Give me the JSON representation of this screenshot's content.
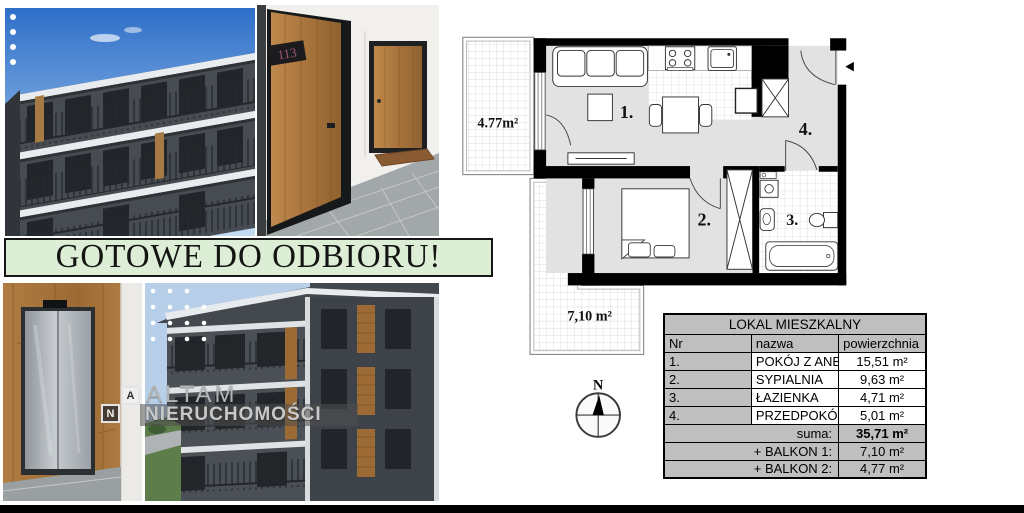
{
  "banner": {
    "text": "GOTOWE DO ODBIORU!"
  },
  "watermark": {
    "logo_a": "A",
    "logo_n": "N",
    "line1": "ALTAM",
    "line2": "NIERUCHOMOŚCI"
  },
  "photos": {
    "door_plate_number": "113"
  },
  "plan": {
    "balcony_top_left_area": "4.77m²",
    "balcony_bottom_area": "7,10 m²",
    "rooms": {
      "r1": "1.",
      "r2": "2.",
      "r3": "3.",
      "r4": "4."
    },
    "compass_north": "N"
  },
  "table": {
    "title": "LOKAL MIESZKALNY",
    "col_nr": "Nr",
    "col_name": "nazwa",
    "col_area": "powierzchnia",
    "rows": [
      {
        "nr": "1.",
        "name": "POKÓJ Z ANEKSEM",
        "area": "15,51 m²"
      },
      {
        "nr": "2.",
        "name": "SYPIALNIA",
        "area": "9,63 m²"
      },
      {
        "nr": "3.",
        "name": "ŁAZIENKA",
        "area": "4,71 m²"
      },
      {
        "nr": "4.",
        "name": "PRZEDPOKÓJ",
        "area": "5,01 m²"
      }
    ],
    "sum_label": "suma:",
    "sum_value": "35,71 m²",
    "balkon1_label": "+ BALKON 1:",
    "balkon1_value": "7,10 m²",
    "balkon2_label": "+ BALKON 2:",
    "balkon2_value": "4,77 m²"
  },
  "colors": {
    "banner_bg": "#dcefd6",
    "table_gray": "#bfbfbf",
    "plan_floor_gray": "#e2e2e2",
    "plan_wall": "#000000",
    "facade_dark": "#474c52",
    "wood_brown": "#a9743c"
  }
}
